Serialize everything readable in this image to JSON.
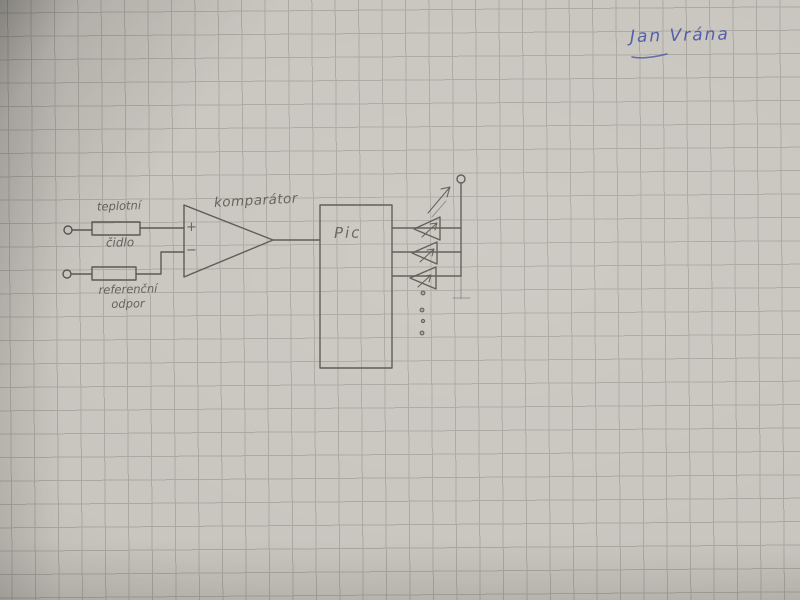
{
  "paper": {
    "base_color": "#c9c6bf",
    "grid_color": "#8f8c85"
  },
  "signature": {
    "text": "Jan Vrána",
    "ink_color": "#4a55a8"
  },
  "schematic": {
    "pencil_color": "#57544d",
    "labels": {
      "sensor_line1": "teplotní",
      "sensor_line2": "čidlo",
      "reference_line1": "referenční",
      "reference_line2": "odpor",
      "comparator": "komparátor",
      "comparator_plus": "+",
      "comparator_minus": "−",
      "mcu": "Pic"
    },
    "led_count": 3,
    "ellipsis_dot_count": 4
  }
}
